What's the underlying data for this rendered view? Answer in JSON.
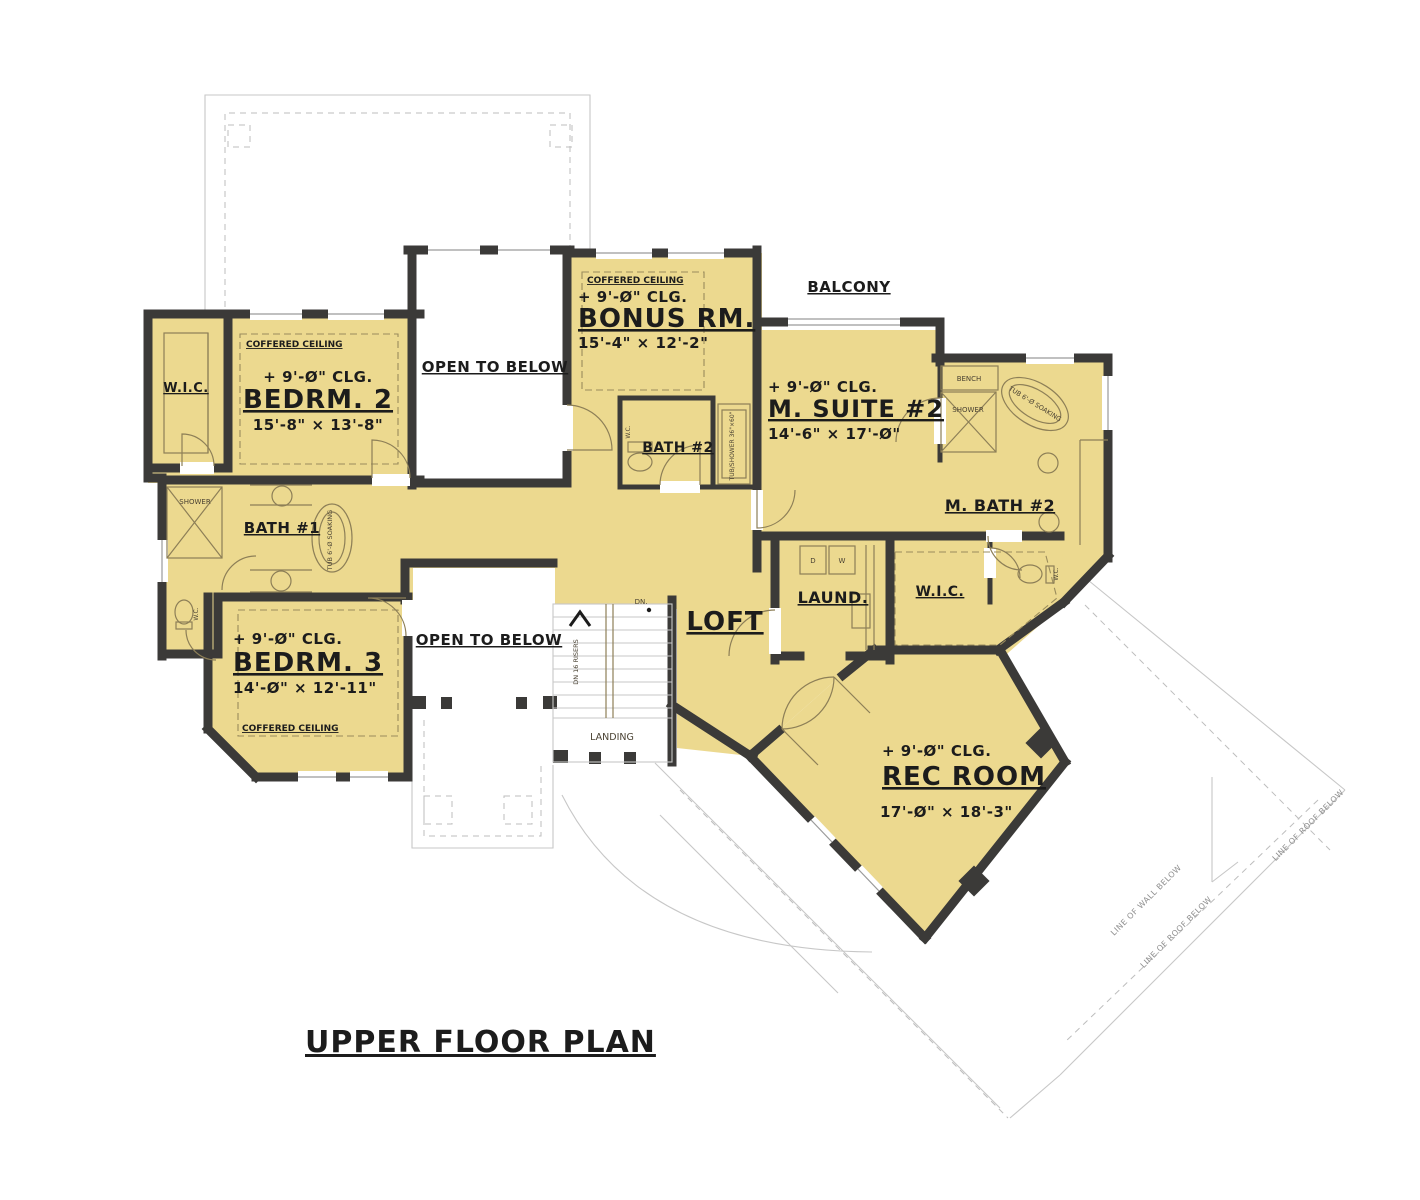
{
  "title": "UPPER FLOOR PLAN",
  "colors": {
    "floor": "#ecd98f",
    "wall": "#3b3a38",
    "detail_line": "#8d7f57",
    "roof_line": "#c7c7c7",
    "text": "#1c1c1c"
  },
  "rooms": {
    "wic_left": {
      "label": "W.I.C."
    },
    "bedrm2": {
      "ceiling": "COFFERED CEILING",
      "clg": "+ 9'-Ø\" CLG.",
      "name": "BEDRM. 2",
      "dims": "15'-8\" × 13'-8\""
    },
    "open_below_1": {
      "label": "OPEN TO BELOW"
    },
    "bonus": {
      "ceiling": "COFFERED CEILING",
      "clg": "+ 9'-Ø\" CLG.",
      "name": "BONUS RM.",
      "dims": "15'-4\" × 12'-2\""
    },
    "balcony": {
      "label": "BALCONY"
    },
    "msuite2": {
      "clg": "+ 9'-Ø\" CLG.",
      "name": "M. SUITE #2",
      "dims": "14'-6\" × 17'-Ø\""
    },
    "bath2": {
      "label": "BATH #2",
      "wc": "W.C.",
      "tubshower": "TUB/SHOWER 36\"×60\""
    },
    "mbath2": {
      "label": "M. BATH #2",
      "bench": "BENCH",
      "shower": "SHOWER",
      "tub": "TUB 6'-Ø SOAKING",
      "wc": "W.C."
    },
    "bath1": {
      "label": "BATH #1",
      "shower": "SHOWER",
      "tub": "TUB 6'-Ø SOAKING",
      "wc": "W.C."
    },
    "bedrm3": {
      "ceiling": "COFFERED CEILING",
      "clg": "+ 9'-Ø\" CLG.",
      "name": "BEDRM. 3",
      "dims": "14'-Ø\" × 12'-11\""
    },
    "open_below_2": {
      "label": "OPEN TO BELOW"
    },
    "loft": {
      "label": "LOFT"
    },
    "laund": {
      "label": "LAUND.",
      "dryer": "D",
      "washer": "W"
    },
    "wic_right": {
      "label": "W.I.C."
    },
    "rec": {
      "clg": "+ 9'-Ø\" CLG.",
      "name": "REC ROOM",
      "dims": "17'-Ø\" × 18'-3\""
    },
    "stairs": {
      "landing": "LANDING",
      "dn": "DN.",
      "risers": "DN 16 RISERS"
    }
  },
  "annotations": {
    "wall_below": "LINE OF WALL BELOW",
    "roof_below": "LINE OF ROOF BELOW"
  }
}
